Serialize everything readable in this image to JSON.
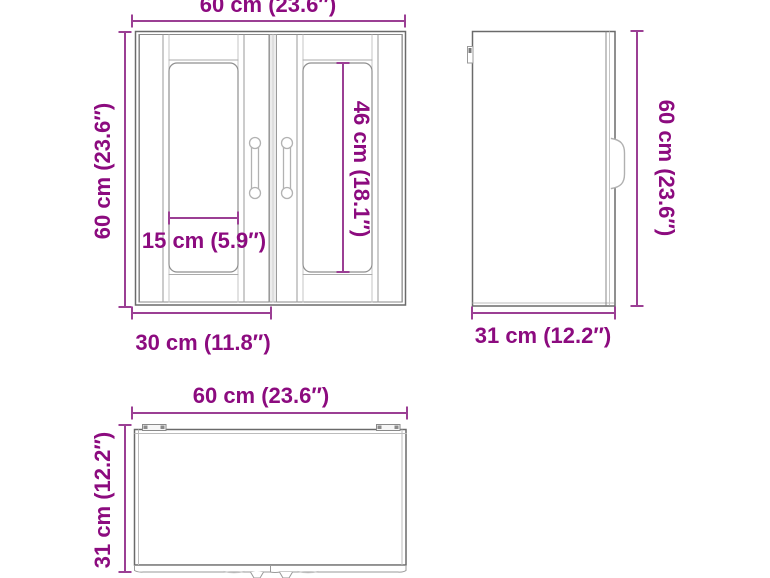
{
  "document_title": "Wall cabinet dimension diagram",
  "colors": {
    "dimension_text": "#8c0b7f",
    "dimension_line": "#9b3f94",
    "drawing_line_dark": "#6a6a6a",
    "drawing_line_medium": "#8f8f8f",
    "drawing_line_light": "#b9b9b9",
    "background": "#ffffff"
  },
  "views": {
    "front": {
      "name": "front-view",
      "width_label": "60 cm (23.6″)",
      "height_label": "60 cm (23.6″)",
      "glass_width_label": "15 cm (5.9″)",
      "glass_height_label": "46 cm (18.1″)",
      "door_width_label": "30 cm (11.8″)"
    },
    "side": {
      "name": "side-view",
      "height_label": "60 cm (23.6″)",
      "depth_label": "31 cm (12.2″)"
    },
    "top": {
      "name": "top-view",
      "width_label": "60 cm (23.6″)",
      "depth_label": "31 cm (12.2″)"
    }
  }
}
